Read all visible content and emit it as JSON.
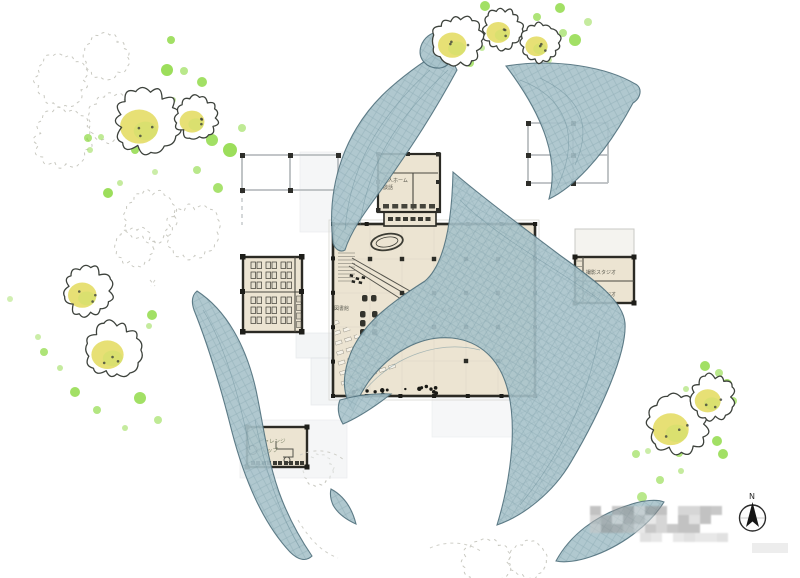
{
  "image_type": "hand-drawn architectural site plan (watercolor style)",
  "labels": {
    "elderly_home": {
      "line1": "老人ホーム",
      "line2": "談話"
    },
    "library": "図書館",
    "hall": "展示設計",
    "studio": {
      "line1": "撮影スタジオ",
      "line2": "録音スタジオ"
    },
    "shop": {
      "line1": "チャレンジ",
      "line2": "ショップ"
    },
    "compass_north": "N"
  },
  "colors": {
    "roof_fill": "#a7c2ca",
    "roof_line": "#6d909b",
    "roof_edge": "#50707c",
    "building_fill": "#ece4d2",
    "building_border": "#2b2a24",
    "tree_outline": "#3d423c",
    "tree_yellow": "#e4dd66",
    "tree_green": "#cfe06a",
    "dot_green": "#8bd83e",
    "sketch": "#c9c9c1",
    "grid": "#b9bdc0",
    "plaza": "#eceff1",
    "watermark": "#a9a9a9",
    "furniture_dark": "#33332c",
    "label_gray": "#6b6b5e"
  },
  "trees": [
    {
      "x": 147,
      "y": 121,
      "r": 31
    },
    {
      "x": 197,
      "y": 118,
      "r": 20
    },
    {
      "x": 88,
      "y": 291,
      "r": 23
    },
    {
      "x": 114,
      "y": 350,
      "r": 26
    },
    {
      "x": 458,
      "y": 41,
      "r": 23
    },
    {
      "x": 503,
      "y": 29,
      "r": 19
    },
    {
      "x": 541,
      "y": 43,
      "r": 18
    },
    {
      "x": 678,
      "y": 424,
      "r": 29
    },
    {
      "x": 713,
      "y": 397,
      "r": 21
    }
  ],
  "sketch_trees": [
    {
      "x": 62,
      "y": 80,
      "r": 25
    },
    {
      "x": 107,
      "y": 57,
      "r": 21
    },
    {
      "x": 63,
      "y": 139,
      "r": 27
    },
    {
      "x": 112,
      "y": 118,
      "r": 22
    },
    {
      "x": 150,
      "y": 216,
      "r": 24
    },
    {
      "x": 192,
      "y": 232,
      "r": 26
    },
    {
      "x": 135,
      "y": 247,
      "r": 18
    },
    {
      "x": 318,
      "y": 470,
      "r": 14
    },
    {
      "x": 487,
      "y": 562,
      "r": 22
    },
    {
      "x": 528,
      "y": 560,
      "r": 17
    }
  ],
  "green_dots": [
    [
      171,
      40,
      4,
      0.8
    ],
    [
      167,
      70,
      6,
      0.85
    ],
    [
      184,
      71,
      4,
      0.6
    ],
    [
      202,
      82,
      5,
      0.8
    ],
    [
      173,
      100,
      3,
      0.5
    ],
    [
      88,
      138,
      4,
      0.7
    ],
    [
      101,
      137,
      3,
      0.55
    ],
    [
      135,
      150,
      4,
      0.8
    ],
    [
      90,
      150,
      3,
      0.5
    ],
    [
      108,
      193,
      5,
      0.85
    ],
    [
      120,
      183,
      3,
      0.5
    ],
    [
      212,
      140,
      6,
      0.8
    ],
    [
      197,
      170,
      4,
      0.6
    ],
    [
      218,
      188,
      5,
      0.75
    ],
    [
      230,
      150,
      7,
      0.85
    ],
    [
      242,
      128,
      4,
      0.55
    ],
    [
      155,
      172,
      3,
      0.45
    ],
    [
      152,
      315,
      5,
      0.8
    ],
    [
      149,
      326,
      3,
      0.5
    ],
    [
      44,
      352,
      4,
      0.7
    ],
    [
      60,
      368,
      3,
      0.5
    ],
    [
      75,
      392,
      5,
      0.8
    ],
    [
      97,
      410,
      4,
      0.65
    ],
    [
      140,
      398,
      6,
      0.8
    ],
    [
      158,
      420,
      4,
      0.55
    ],
    [
      38,
      337,
      3,
      0.45
    ],
    [
      125,
      428,
      3,
      0.5
    ],
    [
      10,
      299,
      3,
      0.4
    ],
    [
      485,
      6,
      5,
      0.8
    ],
    [
      507,
      18,
      4,
      0.6
    ],
    [
      537,
      17,
      4,
      0.7
    ],
    [
      560,
      8,
      5,
      0.8
    ],
    [
      563,
      33,
      4,
      0.6
    ],
    [
      482,
      48,
      3,
      0.5
    ],
    [
      470,
      63,
      4,
      0.7
    ],
    [
      575,
      40,
      6,
      0.8
    ],
    [
      588,
      22,
      4,
      0.5
    ],
    [
      549,
      60,
      3,
      0.45
    ],
    [
      705,
      366,
      5,
      0.8
    ],
    [
      719,
      373,
      4,
      0.6
    ],
    [
      727,
      384,
      5,
      0.8
    ],
    [
      686,
      389,
      3,
      0.5
    ],
    [
      733,
      401,
      4,
      0.65
    ],
    [
      717,
      441,
      5,
      0.8
    ],
    [
      636,
      454,
      4,
      0.6
    ],
    [
      648,
      451,
      3,
      0.45
    ],
    [
      679,
      453,
      4,
      0.7
    ],
    [
      723,
      454,
      5,
      0.8
    ],
    [
      681,
      471,
      3,
      0.5
    ],
    [
      660,
      480,
      4,
      0.6
    ],
    [
      642,
      497,
      5,
      0.6
    ]
  ],
  "watermark": {
    "x": 590,
    "y": 506,
    "cols": 12,
    "rows": 3,
    "cell": 11,
    "extra": {
      "x": 640,
      "y": 533,
      "cols": 8,
      "rows": 1
    }
  }
}
